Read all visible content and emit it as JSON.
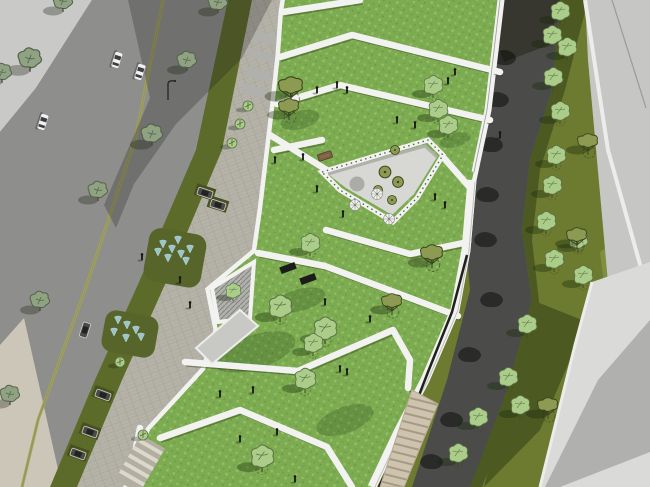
{
  "scene": {
    "type": "3d-architectural-aerial-render",
    "subject": "Bird's-eye SketchUp-style rendering of a terraced green-roof building beside a street with plaza, fountains, parking, and a curved dark park path flanked by lawns and empty plots",
    "style": "line render, flat shading, no visible text"
  },
  "palette": {
    "olive_field": "#6d7b31",
    "olive_shadow": "#4c5a22",
    "olive_strip": "#5c6a2a",
    "olive_island": "#57652a",
    "grass": "#7dab51",
    "grass_light": "#93bf63",
    "grass_dark": "#6b9a45",
    "road": "#8e8e8c",
    "centerline": "#a6a73c",
    "plaza_light": "#c9c9c7",
    "paver": "#b5b2a8",
    "paver_line": "#a5a298",
    "pale_walk": "#cbc6b8",
    "parapet": "#f2f2f0",
    "facade_line": "#c0c0bc",
    "seam_dark": "#20201e",
    "courtyard_floor": "#d7d7d3",
    "wall_gray": "#b0b0ac",
    "hatch_line": "#83837f",
    "path_dark": "#4b4b49",
    "path_shadow": "#37372f",
    "plot_light": "#c6c6c4",
    "plot_lighter": "#dadad8",
    "plot_shadow": "#b0b0ae",
    "plot_edge": "#ececea",
    "steps_tan": "#cdc3ae",
    "steps_line": "#a79a82",
    "tree_light": "#abcd8a",
    "tree_light_edge": "#5c6e46",
    "tree_olive": "#8d9b52",
    "tree_branch": "#39441f",
    "tree_gray": "#8fa383",
    "tree_gray_edge": "#55614b",
    "water": "#a5d6ea",
    "person": "#161614",
    "car_white": "#f1f1ef",
    "car_dark": "#4a4a48",
    "bench": "#7b5f43",
    "planter_circle": "#ababa7"
  },
  "instances": [
    {
      "name": "street-tree",
      "symbol": "#sym-tree-street",
      "layer": "#layer-street-veg",
      "items": [
        [
          30,
          62,
          1.2
        ],
        [
          63,
          4
        ],
        [
          2,
          75
        ],
        [
          187,
          63
        ],
        [
          152,
          137,
          1.1
        ],
        [
          98,
          193
        ],
        [
          218,
          5
        ],
        [
          40,
          303
        ],
        [
          10,
          397
        ]
      ]
    },
    {
      "name": "small-tree",
      "symbol": "#sym-tree-small",
      "layer": "#layer-street-veg",
      "items": [
        [
          248,
          106
        ],
        [
          240,
          124
        ],
        [
          232,
          143
        ],
        [
          120,
          362
        ],
        [
          143,
          435
        ]
      ]
    },
    {
      "name": "roof-tree",
      "symbol": "#sym-tree-light",
      "layer": "#layer-roof-veg",
      "items": [
        [
          438,
          112
        ],
        [
          448,
          128
        ],
        [
          433,
          88
        ],
        [
          310,
          246
        ],
        [
          280,
          310,
          1.2
        ],
        [
          325,
          332,
          1.2
        ],
        [
          313,
          346
        ],
        [
          305,
          382,
          1.1
        ],
        [
          262,
          460,
          1.2
        ],
        [
          233,
          293,
          0.8
        ]
      ]
    },
    {
      "name": "roof-tree-olive",
      "symbol": "#sym-tree-olive",
      "layer": "#layer-roof-veg",
      "items": [
        [
          291,
          88,
          1.2
        ],
        [
          289,
          108
        ],
        [
          392,
          303
        ],
        [
          432,
          255,
          1.1
        ]
      ]
    },
    {
      "name": "courtyard-shrub",
      "symbol": "#sym-bush",
      "layer": "#layer-roof-veg",
      "items": [
        [
          385,
          172,
          1.3
        ],
        [
          398,
          182,
          1.2
        ],
        [
          392,
          200
        ],
        [
          378,
          190
        ],
        [
          395,
          150
        ]
      ]
    },
    {
      "name": "bank-tree",
      "symbol": "#sym-tree-light",
      "layer": "#layer-east-veg",
      "items": [
        [
          560,
          14
        ],
        [
          552,
          38
        ],
        [
          567,
          50
        ],
        [
          553,
          80
        ],
        [
          560,
          114
        ],
        [
          556,
          158
        ],
        [
          552,
          188
        ],
        [
          546,
          224
        ],
        [
          554,
          262
        ],
        [
          578,
          242
        ],
        [
          583,
          278
        ],
        [
          527,
          327
        ],
        [
          508,
          380
        ],
        [
          478,
          420
        ],
        [
          458,
          456
        ],
        [
          520,
          408
        ]
      ]
    },
    {
      "name": "bank-tree-olive",
      "symbol": "#sym-tree-olive",
      "layer": "#layer-east-veg",
      "items": [
        [
          588,
          143
        ],
        [
          577,
          237
        ],
        [
          548,
          407
        ]
      ]
    },
    {
      "name": "path-tree-shadow",
      "symbol": "#sym-blob",
      "layer": "#layer-path-shadows",
      "items": [
        [
          505,
          58
        ],
        [
          498,
          100
        ],
        [
          492,
          145
        ],
        [
          488,
          195
        ],
        [
          486,
          240
        ],
        [
          492,
          300
        ],
        [
          470,
          355
        ],
        [
          452,
          420
        ],
        [
          432,
          462
        ]
      ]
    },
    {
      "name": "person",
      "symbol": "#sym-person",
      "layer": "#layer-people",
      "items": [
        [
          317,
          93
        ],
        [
          337,
          88
        ],
        [
          347,
          93
        ],
        [
          455,
          75
        ],
        [
          448,
          84
        ],
        [
          415,
          128
        ],
        [
          397,
          123
        ],
        [
          303,
          160
        ],
        [
          275,
          163
        ],
        [
          317,
          192
        ],
        [
          343,
          217
        ],
        [
          435,
          200
        ],
        [
          445,
          208
        ],
        [
          142,
          260
        ],
        [
          180,
          283
        ],
        [
          190,
          308
        ],
        [
          325,
          305
        ],
        [
          370,
          322
        ],
        [
          340,
          372
        ],
        [
          347,
          375
        ],
        [
          220,
          397
        ],
        [
          253,
          393
        ],
        [
          277,
          435
        ],
        [
          240,
          442
        ],
        [
          295,
          482
        ],
        [
          500,
          138
        ]
      ]
    },
    {
      "name": "car",
      "symbol": "#sym-car-white",
      "layer": "#layer-vehicles",
      "items": [
        [
          117,
          60,
          1,
          108
        ],
        [
          140,
          72,
          1,
          108
        ],
        [
          43,
          122,
          1,
          108
        ]
      ]
    },
    {
      "name": "parked-car",
      "symbol": "#sym-car-dark",
      "layer": "#layer-vehicles",
      "items": [
        [
          205,
          193,
          1,
          18
        ],
        [
          218,
          205,
          1,
          18
        ],
        [
          85,
          330,
          1,
          108
        ],
        [
          103,
          395,
          1,
          20
        ],
        [
          90,
          432,
          1,
          20
        ],
        [
          78,
          454,
          1,
          20
        ]
      ]
    },
    {
      "name": "fountain-jet",
      "symbol": "#sym-jet",
      "layer": "#layer-water",
      "items": [
        [
          163,
          247
        ],
        [
          172,
          252
        ],
        [
          181,
          257
        ],
        [
          190,
          252
        ],
        [
          178,
          243
        ],
        [
          168,
          261
        ],
        [
          186,
          264
        ],
        [
          158,
          255
        ],
        [
          118,
          323
        ],
        [
          127,
          328
        ],
        [
          136,
          333
        ],
        [
          126,
          341
        ],
        [
          141,
          340
        ],
        [
          114,
          335
        ]
      ]
    },
    {
      "name": "parasol",
      "symbol": "#sym-parasol",
      "layer": "#layer-roof-veg",
      "items": [
        [
          355,
          205
        ],
        [
          377,
          194
        ],
        [
          389,
          219
        ]
      ]
    },
    {
      "name": "skylight",
      "symbol": "#sym-skylight",
      "layer": "#layer-roof-extra",
      "items": [
        [
          288,
          268,
          1,
          -20
        ],
        [
          308,
          279,
          1,
          -20
        ]
      ]
    }
  ]
}
